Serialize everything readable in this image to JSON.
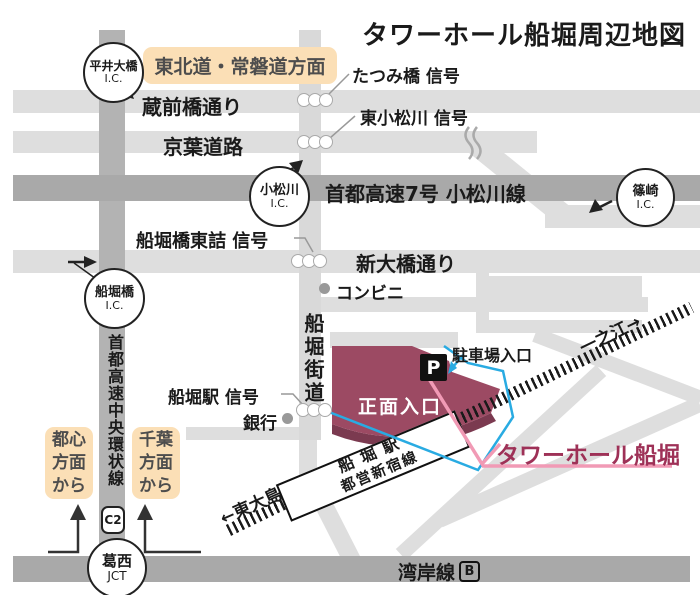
{
  "title": "タワーホール船堀周辺地図",
  "colors": {
    "building": "#9c4a63",
    "building_shadow": "#7b3a50",
    "accent_blue": "#29abe2",
    "accent_pink": "#f19ab5",
    "badge_bg": "#fbdfb6",
    "road_light": "#dedede",
    "road_dark": "#a9a9a9"
  },
  "badges": {
    "tohoku": "東北道・常磐道方面",
    "from_toshin": "都心\n方面\nから",
    "from_chiba": "千葉\n方面\nから"
  },
  "interchanges": {
    "hirai": {
      "name": "平井大橋",
      "sub": "I.C."
    },
    "komatsugawa": {
      "name": "小松川",
      "sub": "I.C."
    },
    "shinozaki": {
      "name": "篠崎",
      "sub": "I.C."
    },
    "funaboribashi": {
      "name": "船堀橋",
      "sub": "I.C."
    },
    "kasai": {
      "name": "葛西",
      "sub": "JCT"
    }
  },
  "roads": {
    "kuramaebashi": "蔵前橋通り",
    "keiyo": "京葉道路",
    "shuto7": "首都高速7号 小松川線",
    "shinohashi": "新大橋通り",
    "funabori_kaido": "船堀街道",
    "chuo_kanjo": "首都高速中央環状線",
    "c2": "C2",
    "wangan": "湾岸線",
    "wangan_route_mark": "B"
  },
  "signals": {
    "tatsumibashi": "たつみ橋 信号",
    "higashi_komatsugawa": "東小松川 信号",
    "funaboribashi_higashizume": "船堀橋東詰 信号",
    "funabori_eki": "船堀駅 信号"
  },
  "landmarks": {
    "conbini": "コンビニ",
    "bank": "銀行",
    "parking_entrance": "駐車場入口",
    "parking_mark": "P",
    "main_entrance": "正面入口",
    "tower_hall": "タワーホール船堀"
  },
  "station": {
    "name": "船堀駅",
    "line": "都営新宿線"
  },
  "directions": {
    "ichinoe": "一之江→",
    "higashi_ojima": "←東大島"
  }
}
